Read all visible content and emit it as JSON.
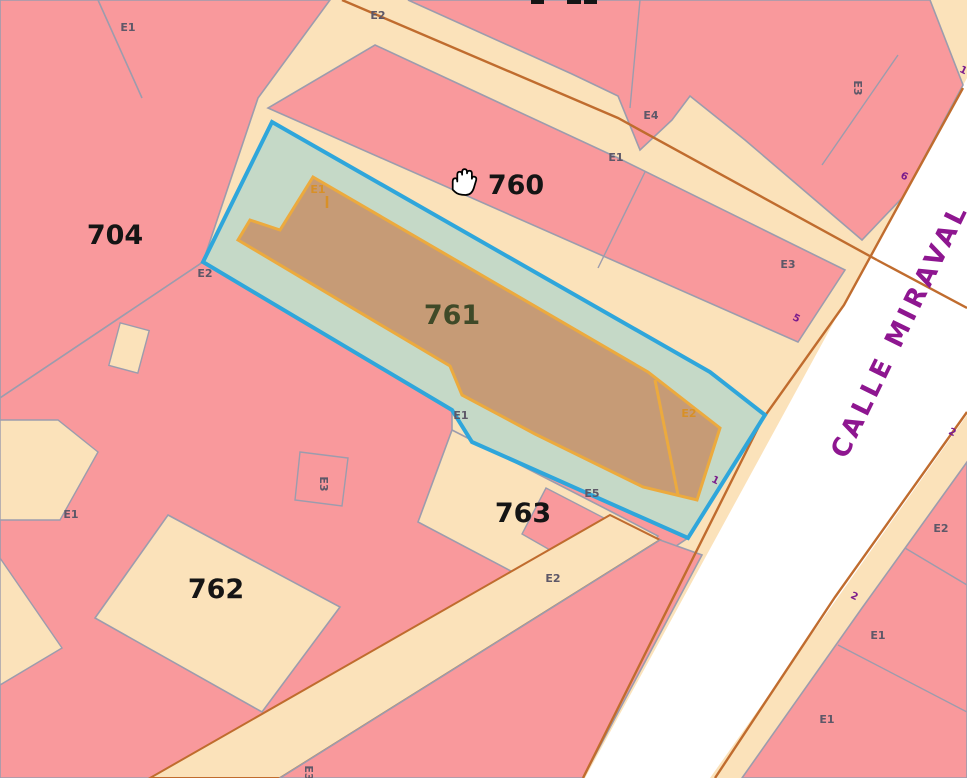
{
  "map_type": "cadastral-parcel-map",
  "selected_parcel_id": "761",
  "colors": {
    "block_pink": "#F9999C",
    "ground_cream": "#FBE2BA",
    "street_white": "#FFFFFF",
    "boundary_gray": "#9C9CAD",
    "road_edge_brown": "#C06C2E",
    "selected_parcel_fill": "#C5D9C7",
    "selected_parcel_border": "#2FA6DB",
    "building_fill": "#C69B76",
    "building_border": "#ECAA3E",
    "label_black": "#151515",
    "label_olive": "#3F4A28",
    "label_gray": "#5E5868",
    "label_orange": "#D89027",
    "street_name_purple": "#8E1690",
    "street_number_purple": "#7B1C8C"
  },
  "block_labels": [
    {
      "text": "704",
      "x": 115,
      "y": 244
    },
    {
      "text": "760",
      "x": 516,
      "y": 194
    },
    {
      "text": "761",
      "x": 452,
      "y": 324,
      "color": "olive"
    },
    {
      "text": "762",
      "x": 216,
      "y": 598
    },
    {
      "text": "763",
      "x": 523,
      "y": 522
    }
  ],
  "e_labels": [
    {
      "text": "E1",
      "x": 128,
      "y": 31
    },
    {
      "text": "E2",
      "x": 378,
      "y": 19
    },
    {
      "text": "E4",
      "x": 651,
      "y": 119
    },
    {
      "text": "E1",
      "x": 616,
      "y": 161
    },
    {
      "text": "E3",
      "x": 854,
      "y": 88,
      "rot": 90
    },
    {
      "text": "E3",
      "x": 788,
      "y": 268
    },
    {
      "text": "E2",
      "x": 205,
      "y": 277
    },
    {
      "text": "E1",
      "x": 318,
      "y": 193,
      "color": "orange"
    },
    {
      "text": "E2",
      "x": 689,
      "y": 417,
      "color": "orange"
    },
    {
      "text": "E1",
      "x": 461,
      "y": 419
    },
    {
      "text": "E5",
      "x": 592,
      "y": 497
    },
    {
      "text": "E2",
      "x": 553,
      "y": 582
    },
    {
      "text": "E3",
      "x": 320,
      "y": 484,
      "rot": 90
    },
    {
      "text": "E1",
      "x": 71,
      "y": 518
    },
    {
      "text": "E2",
      "x": 941,
      "y": 532
    },
    {
      "text": "E1",
      "x": 878,
      "y": 639
    },
    {
      "text": "E1",
      "x": 827,
      "y": 723
    },
    {
      "text": "E3",
      "x": 305,
      "y": 773,
      "rot": 90
    }
  ],
  "street": {
    "name": "CALLE MIRAVAL",
    "numbers": [
      {
        "text": "1",
        "x": 962,
        "y": 73,
        "rot": 26
      },
      {
        "text": "6",
        "x": 903,
        "y": 179,
        "rot": 26
      },
      {
        "text": "5",
        "x": 795,
        "y": 321,
        "rot": 26
      },
      {
        "text": "1",
        "x": 714,
        "y": 483,
        "rot": 26
      },
      {
        "text": "2",
        "x": 951,
        "y": 435,
        "rot": 26
      },
      {
        "text": "2",
        "x": 853,
        "y": 599,
        "rot": 26
      }
    ]
  },
  "cursor": {
    "type": "open-hand",
    "x": 452,
    "y": 168
  }
}
